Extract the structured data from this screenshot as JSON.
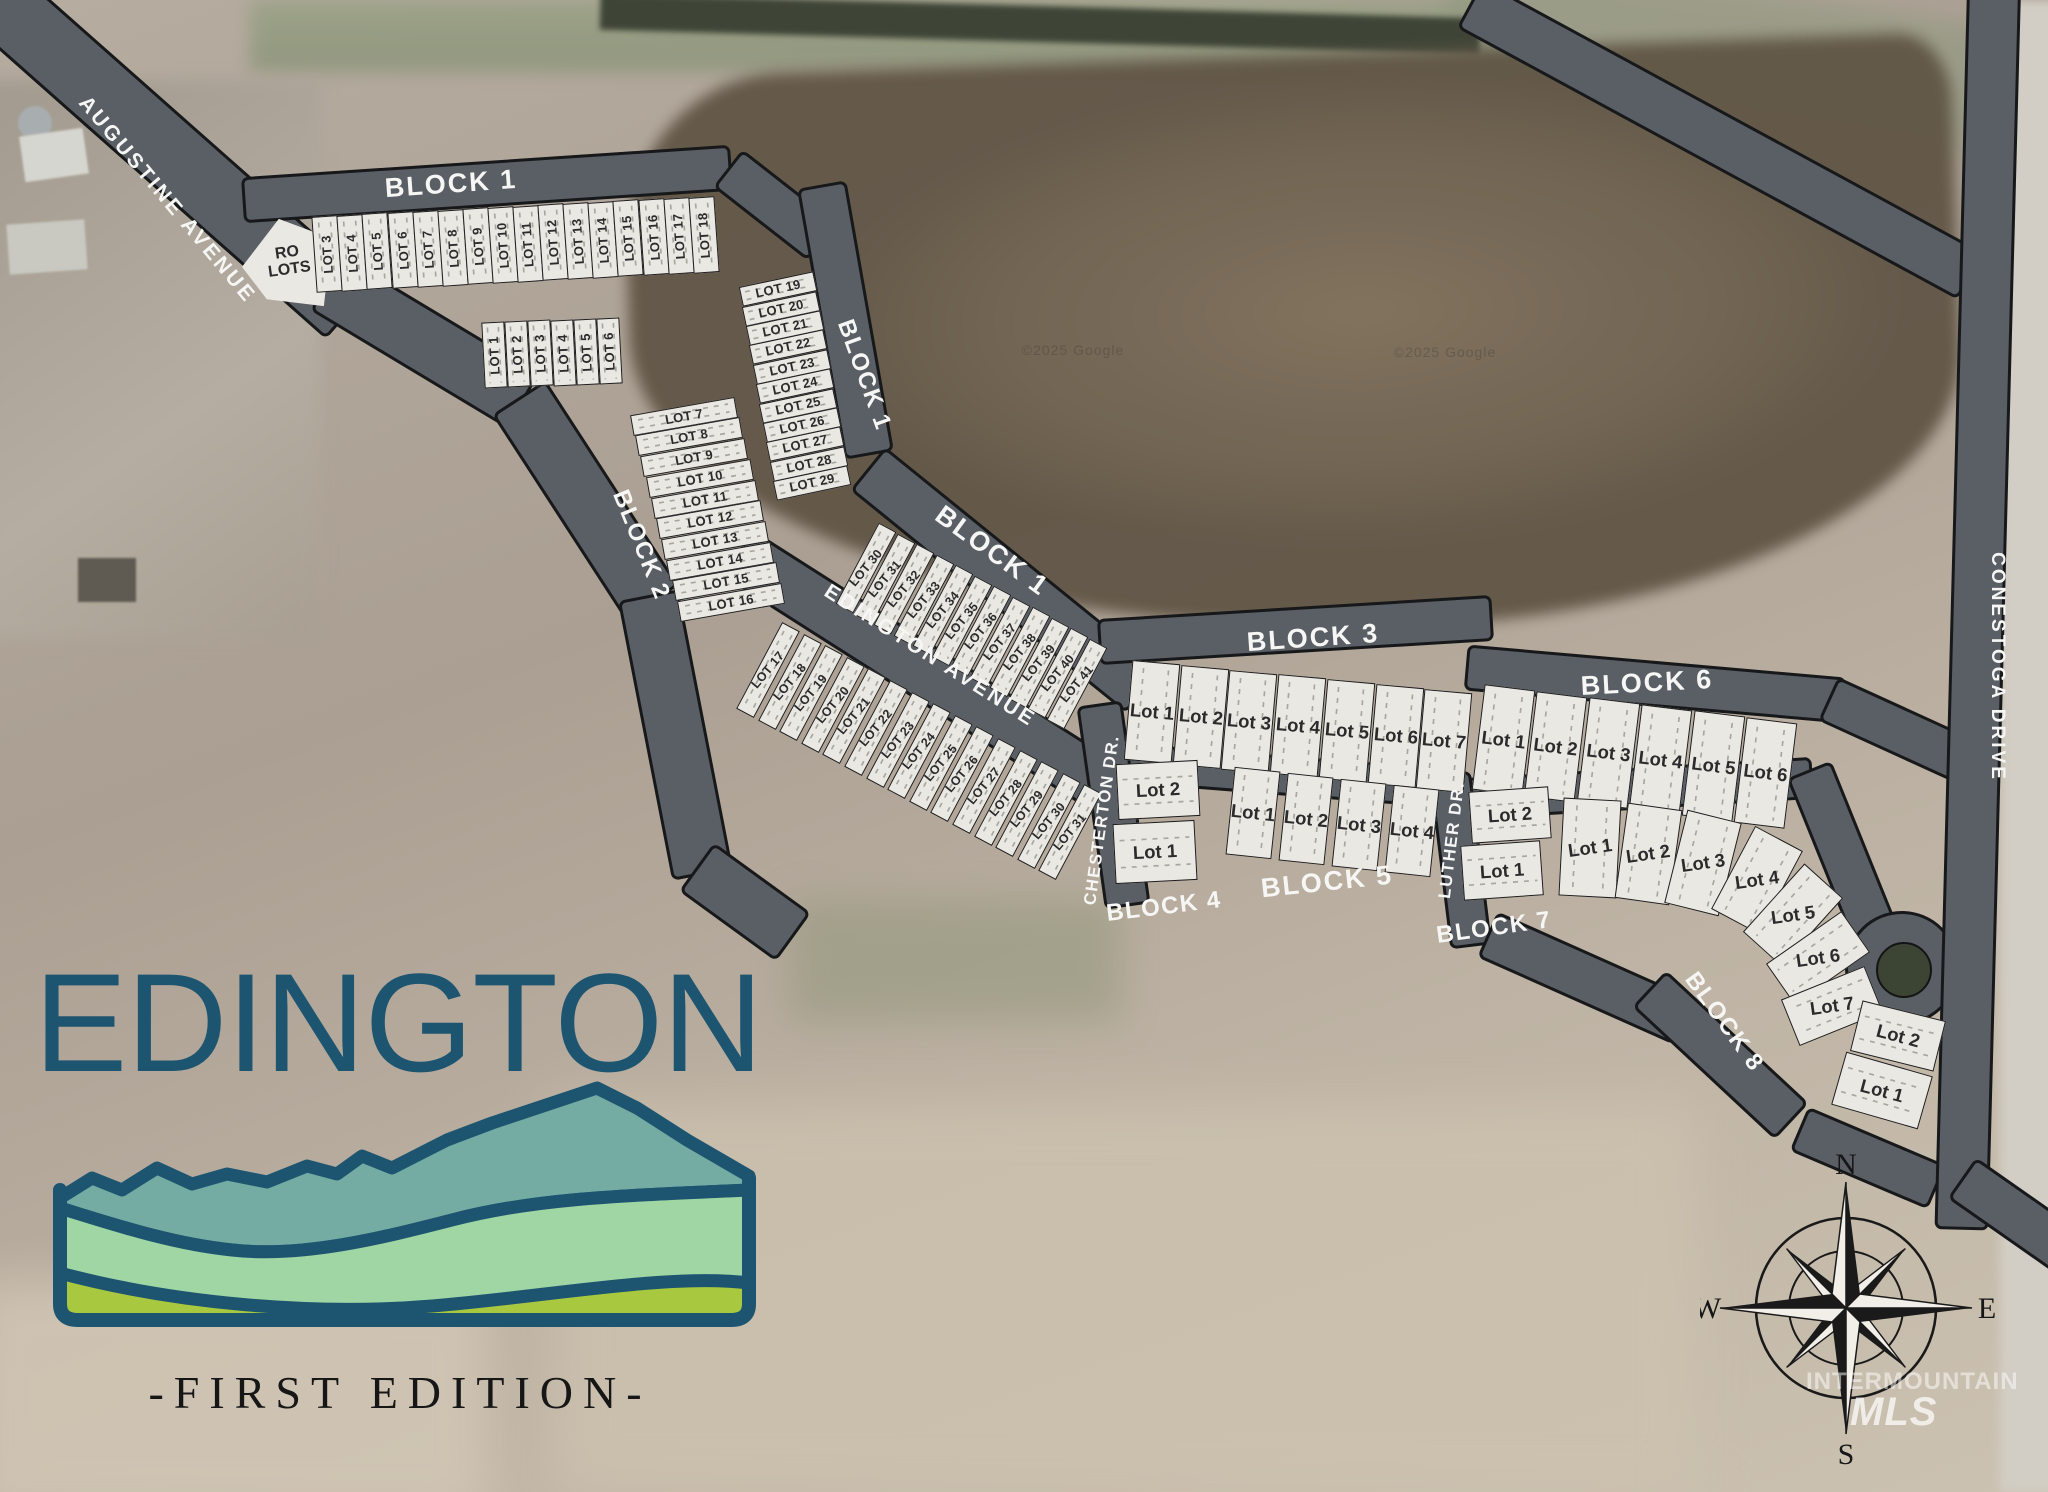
{
  "title": {
    "name": "EDINGTON",
    "edition": "-FIRST EDITION-"
  },
  "streets": {
    "augustine": "AUGUSTINE AVENUE",
    "edington": "EDINGTON AVENUE",
    "chesterton": "CHESTERTON DR.",
    "luther": "LUTHER DR.",
    "conestoga": "CONESTOGA DRIVE"
  },
  "block_labels": {
    "block1": "BLOCK 1",
    "block2": "BLOCK 2",
    "block3": "BLOCK 3",
    "block4": "BLOCK 4",
    "block5": "BLOCK 5",
    "block6": "BLOCK 6",
    "block7": "BLOCK 7",
    "block8": "BLOCK 8"
  },
  "ro_lots": "RO\nLOTS",
  "lot_groups": {
    "block1_top": [
      "LOT 3",
      "LOT 4",
      "LOT 5",
      "LOT 6",
      "LOT 7",
      "LOT 8",
      "LOT 9",
      "LOT 10",
      "LOT 11",
      "LOT 12",
      "LOT 13",
      "LOT 14",
      "LOT 15",
      "LOT 16",
      "LOT 17",
      "LOT 18"
    ],
    "block1_col": [
      "LOT 19",
      "LOT 20",
      "LOT 21",
      "LOT 22",
      "LOT 23",
      "LOT 24",
      "LOT 25",
      "LOT 26",
      "LOT 27",
      "LOT 28",
      "LOT 29"
    ],
    "block1_diag": [
      "LOT 30",
      "LOT 31",
      "LOT 32",
      "LOT 33",
      "LOT 34",
      "LOT 35",
      "LOT 36",
      "LOT 37",
      "LOT 38",
      "LOT 39",
      "LOT 40",
      "LOT 41"
    ],
    "block2_row": [
      "LOT 1",
      "LOT 2",
      "LOT 3",
      "LOT 4",
      "LOT 5",
      "LOT 6"
    ],
    "block2_col": [
      "LOT 7",
      "LOT 8",
      "LOT 9",
      "LOT 10",
      "LOT 11",
      "LOT 12",
      "LOT 13",
      "LOT 14",
      "LOT 15",
      "LOT 16"
    ],
    "block2_diag": [
      "LOT 17",
      "LOT 18",
      "LOT 19",
      "LOT 20",
      "LOT 21",
      "LOT 22",
      "LOT 23",
      "LOT 24",
      "LOT 25",
      "LOT 26",
      "LOT 27",
      "LOT 28",
      "LOT 29",
      "LOT 30",
      "LOT 31"
    ],
    "block3": [
      "Lot 1",
      "Lot 2",
      "Lot 3",
      "Lot 4",
      "Lot 5",
      "Lot 6",
      "Lot 7"
    ],
    "block4": [
      "Lot 2",
      "Lot 1"
    ],
    "block5": [
      "Lot 1",
      "Lot 2",
      "Lot 3",
      "Lot 4"
    ],
    "block6": [
      "Lot 1",
      "Lot 2",
      "Lot 3",
      "Lot 4",
      "Lot 5",
      "Lot 6"
    ],
    "block7": [
      "Lot 2",
      "Lot 1"
    ],
    "block8_fan": [
      "Lot 1",
      "Lot 2",
      "Lot 3",
      "Lot 4",
      "Lot 5",
      "Lot 6",
      "Lot 7"
    ],
    "block8_tail": [
      "Lot 2",
      "Lot 1"
    ]
  },
  "compass": {
    "n": "N",
    "e": "E",
    "s": "S",
    "w": "W"
  },
  "watermarks": {
    "google": "©2025 Google",
    "mls_line1": "INTERMOUNTAIN",
    "mls_line2": "MLS"
  },
  "colors": {
    "road": "#5a5f66",
    "lot_fill": "#eae8e3",
    "title": "#1d5570",
    "mountain_teal": "#74aba3",
    "mountain_green": "#9fd6a4",
    "mountain_yellow": "#a8c93f"
  }
}
